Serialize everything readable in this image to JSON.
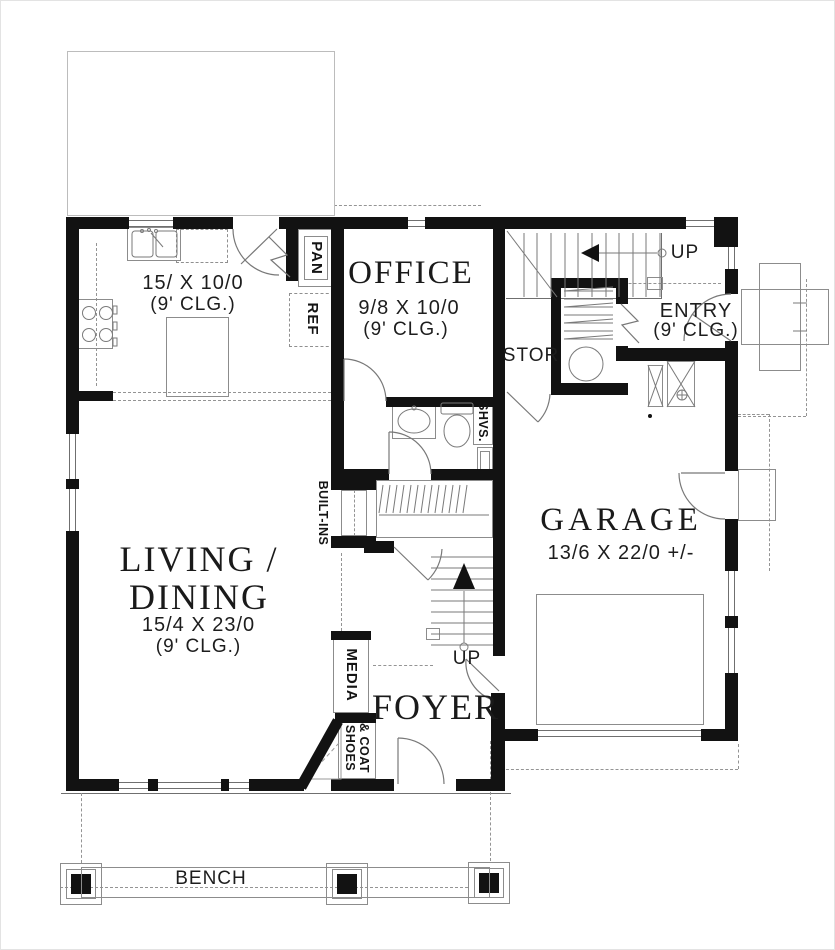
{
  "plan": {
    "rooms": {
      "kitchen": {
        "dim": "15/ X 10/0",
        "clg": "(9' CLG.)"
      },
      "office": {
        "name": "OFFICE",
        "dim": "9/8 X 10/0",
        "clg": "(9' CLG.)"
      },
      "living_dining": {
        "name_line1": "LIVING /",
        "name_line2": "DINING",
        "dim": "15/4 X 23/0",
        "clg": "(9' CLG.)"
      },
      "garage": {
        "name": "GARAGE",
        "dim": "13/6 X 22/0 +/-"
      },
      "entry": {
        "name": "ENTRY",
        "clg": "(9' CLG.)"
      },
      "foyer": {
        "name": "FOYER"
      },
      "stor": {
        "name": "STOR"
      }
    },
    "labels": {
      "up_upper": "UP",
      "up_lower": "UP",
      "pan": "PAN",
      "ref": "REF",
      "shvs": "SHVS.",
      "built_ins": "BUILT-INS",
      "media": "MEDIA",
      "shoes": "SHOES",
      "coat": "& COAT",
      "bench": "BENCH"
    },
    "colors": {
      "wall": "#121212",
      "thin_line": "#8c8c8c",
      "dashed_line": "#949494",
      "text": "#1c1c1c",
      "background": "#ffffff"
    }
  }
}
